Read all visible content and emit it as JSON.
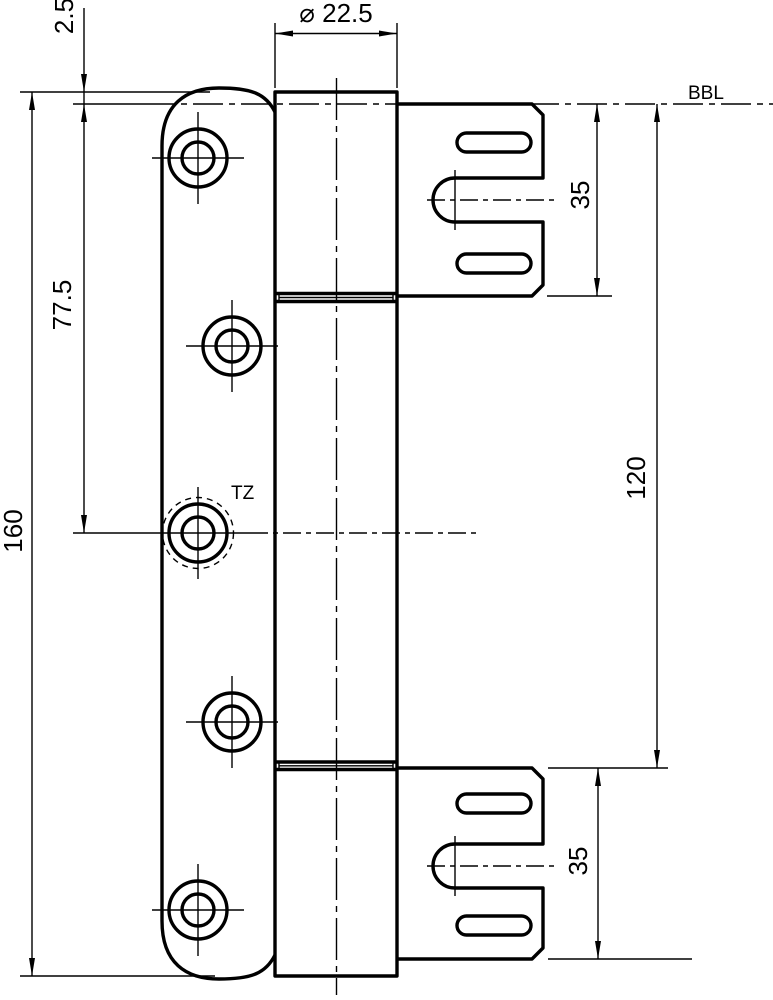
{
  "page": {
    "background": "#ffffff",
    "ink": "#000000"
  },
  "drawing": {
    "kind": "hinge-technical-drawing",
    "reference_line_label": "BBL",
    "center_hole_label": "TZ",
    "dimensions": {
      "knuckle_diameter": "⌀ 22.5",
      "top_edge_to_bbl": "2.5",
      "bbl_to_center_hole": "77.5",
      "leaf_total_height": "160",
      "top_frame_plate_height": "35",
      "bbl_to_bottom_frame_plate": "120",
      "bottom_frame_plate_height": "35"
    }
  }
}
